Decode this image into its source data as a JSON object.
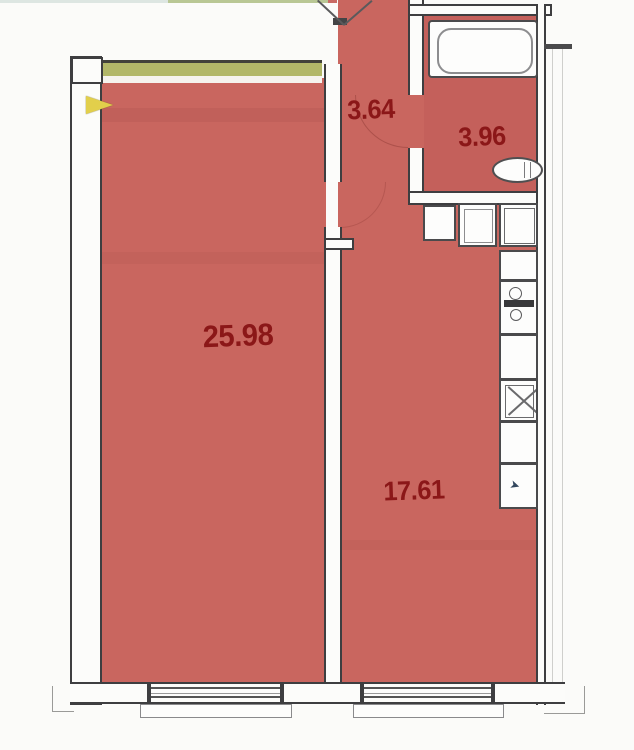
{
  "title": "apartment-floor-plan",
  "colors": {
    "background": "#fbfbf9",
    "room-fill": "#c9665f",
    "label": "#8b1718",
    "wall-line": "#3e3e40",
    "wall-fill": "#fcfcfa",
    "accent-strip": "#b2b768",
    "arrow": "#e2cf4b"
  },
  "rooms": [
    {
      "name": "living-room",
      "area": "25.98"
    },
    {
      "name": "kitchen",
      "area": "17.61"
    },
    {
      "name": "hallway",
      "area": "3.64"
    },
    {
      "name": "bathroom",
      "area": "3.96"
    }
  ],
  "fixtures": {
    "bathroom": [
      "bathtub",
      "washbasin"
    ],
    "kitchen": [
      "washing-machine",
      "cabinet",
      "fridge",
      "stove",
      "hob",
      "sink-unit"
    ],
    "openings": [
      "entrance-door",
      "bathroom-door",
      "living-room-door",
      "window-living",
      "window-kitchen"
    ]
  }
}
